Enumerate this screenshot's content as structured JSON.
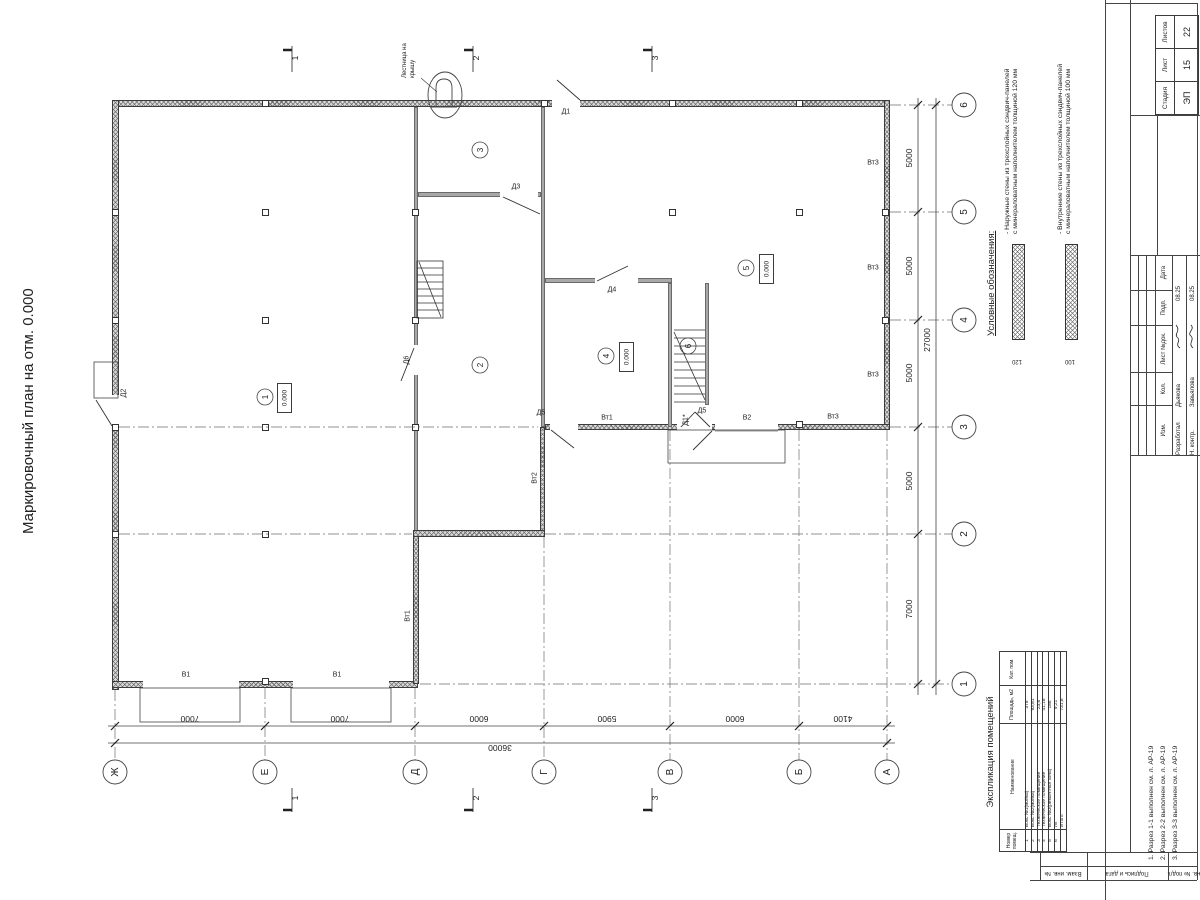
{
  "sheet_title": "Маркировочный план на отм. 0.000",
  "roof_ladder_label": "Лестница на крышу",
  "legend": {
    "title": "Условные обозначения:",
    "items": [
      {
        "text": "- Наружные стены из трехслойных сэндвич-панелей с минераловатным наполнителем толщиной 120 мм",
        "dim": "120"
      },
      {
        "text": "- Внутренние стены из трехслойных сэндвич-панелей с минераловатным наполнителем толщиной 100 мм",
        "dim": "100"
      }
    ]
  },
  "grid": {
    "letters": [
      "Ж",
      "Е",
      "Д",
      "Г",
      "В",
      "Б",
      "А"
    ],
    "numbers": [
      "6",
      "5",
      "4",
      "3",
      "2",
      "1"
    ],
    "dims_bottom": [
      "7000",
      "7000",
      "6000",
      "5900",
      "6000",
      "4100"
    ],
    "total_bottom": "36000",
    "dims_right": [
      "5000",
      "5000",
      "5000",
      "5000",
      "7000"
    ],
    "total_right": "27000"
  },
  "sections": [
    "1",
    "2",
    "3"
  ],
  "rooms": {
    "tags": [
      "1",
      "2",
      "3",
      "4",
      "5",
      "6"
    ],
    "elevation": "0.000"
  },
  "marks": {
    "d1": "Д1",
    "d1s": "Д1*",
    "d2": "Д2",
    "d3": "Д3",
    "d4": "Д4",
    "d5": "Д5",
    "d6": "Д6",
    "g1": "В1",
    "g2": "В2",
    "vt1": "Вт1",
    "vt2": "Вт2",
    "vt3": "Вт3"
  },
  "room_table": {
    "title": "Экспликация помещений",
    "col_num": "Номер помещ.",
    "col_name": "Наименование",
    "col_area": "Площадь, м2",
    "col_cat": "Кат. пом.",
    "rows": [
      [
        "1",
        "Бокс №1(мойка)",
        "378"
      ],
      [
        "2",
        "Бокс №2(мойка)",
        "93,81"
      ],
      [
        "3",
        "Техническое помещение",
        "23,6"
      ],
      [
        "4",
        "Техническое помещение",
        "41,18"
      ],
      [
        "5",
        "Бокс №3(ремонтная зона)",
        "186"
      ],
      [
        "6",
        "Лк",
        "9,21"
      ],
      [
        "",
        "Итого",
        "731,8"
      ]
    ]
  },
  "titleblock": {
    "stage_label": "Стадия",
    "sheet_label": "Лист",
    "sheets_label": "Листов",
    "stage": "ЭП",
    "sheet_no": "15",
    "sheets_total": "22",
    "rev_cols": [
      "Изм.",
      "Кол.",
      "Лист №док.",
      "Подп.",
      "Дата"
    ],
    "signers": [
      {
        "role": "Разработал",
        "name": "Дьякова",
        "date": "08.25"
      },
      {
        "role": "Н. контр.",
        "name": "Завьялова",
        "date": "08.25"
      }
    ],
    "frame_cells": [
      "Взам. инв. №",
      "Подпись и дата",
      "Инв. № подл."
    ]
  },
  "notes": [
    "1. Разрез 1-1 выполнен см. л. АР-19",
    "2. Разрез 2-2 выполнен см. л. АР-19",
    "3. Разрез 3-3 выполнен см. л. АР-19"
  ]
}
